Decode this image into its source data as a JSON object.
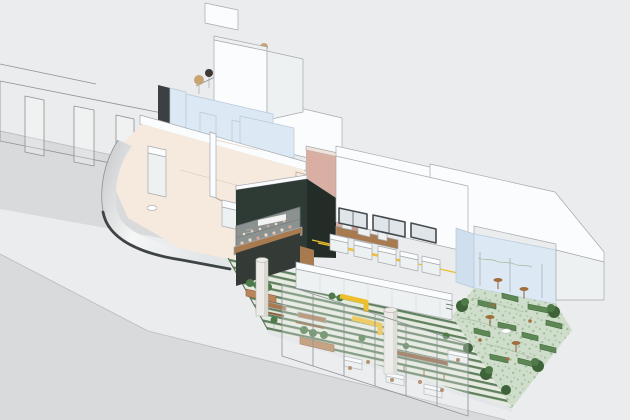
{
  "meta": {
    "kind": "axonometric-architectural-cutaway-illustration",
    "subject": "corner cafe-restaurant interior with green striped deck and planted garden terrace",
    "visible_text": "none legible (tiny scribbled wall sign only)"
  },
  "colors": {
    "bg": "#ebeced",
    "ground_road": "#d9dadb",
    "curb_line": "#bcbec0",
    "outline": "#a6abaf",
    "wire_line": "#8c9296",
    "white_face": "#fbfcfd",
    "white_shade": "#eef1f2",
    "white_shade2": "#e3e6e8",
    "glass_blue": "#dce8f3",
    "glass_blue_dark": "#d0dfee",
    "glass_line": "#b7c9da",
    "dark_wall": "#3b4143",
    "cream_floor": "#f6e9de",
    "cream_line": "#e2d0c0",
    "pink_wall": "#d8afa2",
    "pink_dark": "#c79a8c",
    "pink_cap": "#efe3dc",
    "dark_box": "#2e3a34",
    "dark_box_side": "#232c27",
    "slot_white": "#e9ebe8",
    "wood": "#a87a4f",
    "wood_dark": "#8d6240",
    "wood_light": "#b9855a",
    "deck_base": "#e6ebdf",
    "deck_stripe": "#60805f",
    "deck_edge": "#57705a",
    "terrazzo": "#cfdecb",
    "terrazzo_speck": "#a3bb9e",
    "terrace_line": "#b0c4ab",
    "sofa_green": "#5d8856",
    "sofa_green_dark": "#46693f",
    "plant_green": "#4e7a49",
    "plant_dark": "#3f6339",
    "accent_yellow": "#edbe2e",
    "metal_light": "#f5f6f6",
    "metal_mid": "#c4c7c9",
    "facade_edge_dark": "#3e4346",
    "column_fill": "#ecebe7",
    "column_shade": "#d8d6d0",
    "stool_brown": "#a06f3e",
    "pot_tan": "#c8a473",
    "window_frame": "#454c50",
    "window_glass": "#dfe5e8",
    "panel_joint": "#d9dcde",
    "stick_gray": "#9aa0a3",
    "scribble": "#565b5e"
  },
  "elements": [
    "road-surface",
    "street-wireframe-wall",
    "upper-floor-terrace",
    "terrace-planting",
    "white-parapet",
    "upper-blue-walls",
    "ground-floor-room",
    "curved-glass-facade",
    "white-furniture",
    "dark-kitchen-box",
    "pastry-display-counter",
    "pink-service-wall",
    "wood-back-counter",
    "main-hall",
    "clerestory-windows",
    "service-counter-row",
    "long-front-counter",
    "yellow-handrail",
    "green-striped-deck",
    "deck-planters",
    "yellow-benches",
    "wood-tables",
    "white-cafe-tables",
    "structural-columns",
    "folding-glass-panels",
    "planted-garden-terrace",
    "garden-sofas",
    "bistro-tables",
    "garden-glass-enclosure",
    "right-roof-mass"
  ]
}
